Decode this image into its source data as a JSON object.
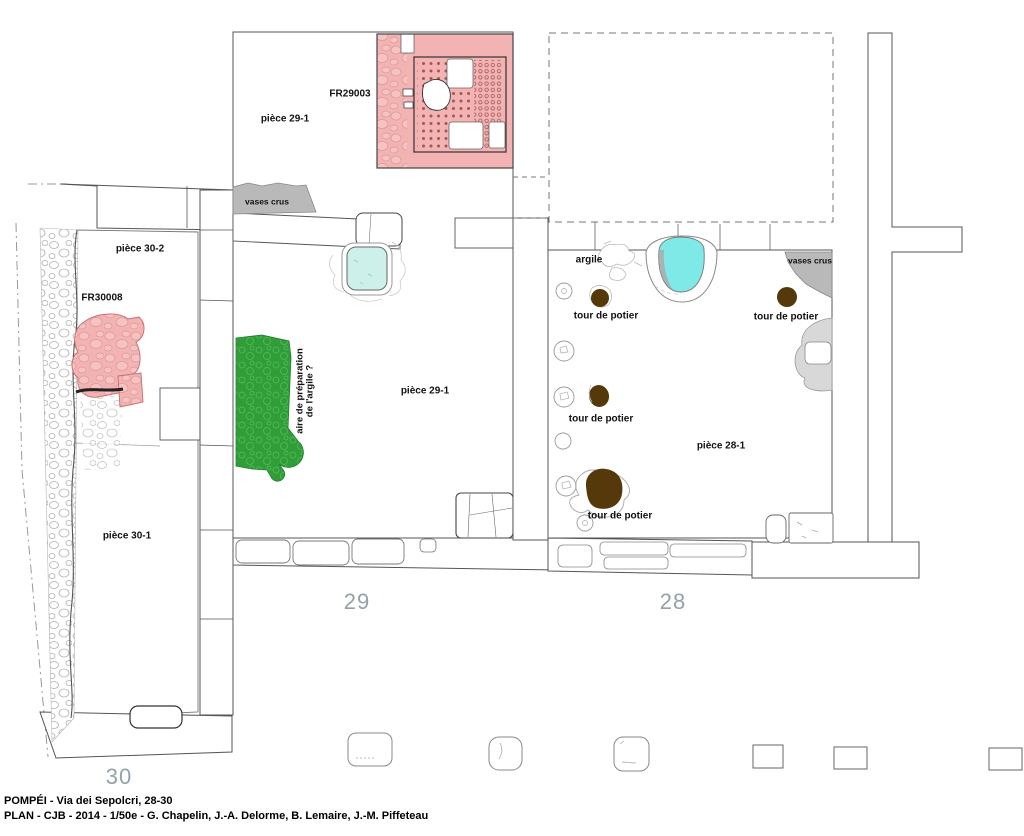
{
  "page": {
    "labels": {
      "fr29003": "FR29003",
      "fr30008": "FR30008",
      "piece_29_1": "pièce 29-1",
      "piece_30_2": "pièce 30-2",
      "piece_30_1": "pièce 30-1",
      "piece_28_1": "pièce 28-1",
      "vases_crus": "vases crus",
      "argile": "argile",
      "clay_area_line1": "aire de préparation",
      "clay_area_line2": "de l'argile ?",
      "tour_de_potier": "tour de potier"
    },
    "street_numbers": {
      "n30": "30",
      "n29": "29",
      "n28": "28"
    },
    "footer": {
      "line1": "POMPÉI - Via dei Sepolcri, 28-30",
      "line2": "PLAN - CJB - 2014 - 1/50e - G. Chapelin, J.-A. Delorme, B. Lemaire, J.-M. Piffeteau"
    },
    "colors": {
      "kiln_pink": "#f3b3b3",
      "kiln_dot": "#a25757",
      "clay_green": "#2f9e38",
      "basin_cyan": "#7ee9e6",
      "basin_cyan_pale": "#cdf1ea",
      "wheel_brown": "#56390b",
      "zone_gray": "#b9b9b9",
      "number_gray": "#93a1ab"
    }
  }
}
